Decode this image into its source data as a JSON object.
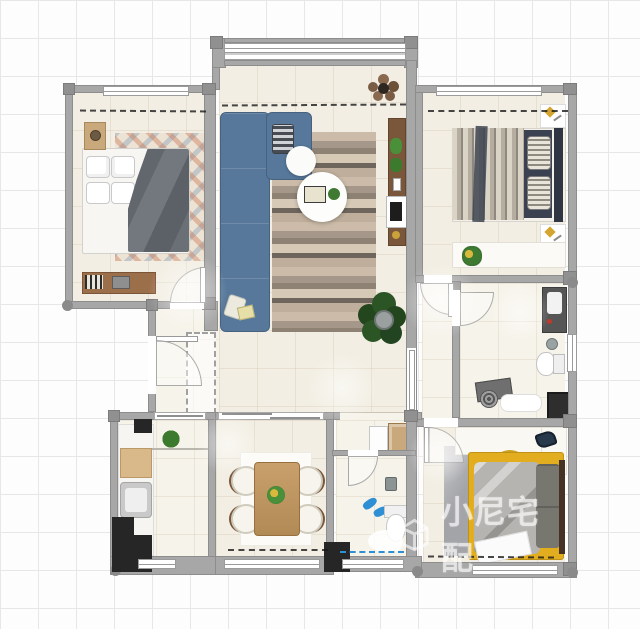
{
  "watermark": {
    "text": "小尼宅配",
    "icon": "house-cube-icon"
  },
  "colors": {
    "page_bg": "#fdfdfd",
    "grid_line": "#e7e7e7",
    "wall": "#a7a7a7",
    "wall_dark": "#8d8d8d",
    "floor": "#f2eee3",
    "floor_light": "#f6f3ea",
    "black_fixture": "#262626",
    "sofa": "#57789a",
    "sofa_dark": "#46627f",
    "duvet": "#6e7278",
    "navy": "#3a4150",
    "wood_light": "#c9a87c",
    "wood_mid": "#9c6f4b",
    "wood_dark": "#7a563b",
    "yellow": "#eec437",
    "plant": "#3f7a33",
    "plant_dark": "#24461f",
    "rug_cream": "#ece3d4",
    "gray_rug": "#a3a4a8",
    "accent_orange": "#c8714f",
    "accent_blue": "#8fa3b5",
    "slipper_blue": "#2e8fd4",
    "watermark": "rgba(255,255,255,0.6)"
  },
  "plan": {
    "rooms": [
      {
        "id": "bedroom-1",
        "furniture": [
          "double-bed",
          "pillows",
          "gray-duvet",
          "patterned-rug",
          "nightstand",
          "table-lamp",
          "desk",
          "books",
          "laptop"
        ]
      },
      {
        "id": "living-room",
        "furniture": [
          "sectional-sofa",
          "striped-pillow",
          "throw-blanket",
          "plank-rug",
          "round-coffee-table",
          "side-table",
          "serving-tray",
          "potted-plant",
          "tv-console",
          "television",
          "dried-plant"
        ]
      },
      {
        "id": "master-bedroom",
        "furniture": [
          "double-bed",
          "striped-duvet",
          "headboard",
          "nightstand",
          "gold-decor",
          "low-dresser",
          "potted-plant"
        ]
      },
      {
        "id": "bathroom-1",
        "furniture": [
          "vanity-sink",
          "toilet",
          "shower-set",
          "floor-drain",
          "bath-mat",
          "washing-machine"
        ]
      },
      {
        "id": "bedroom-2",
        "furniture": [
          "single-bed",
          "yellow-frame",
          "gray-blanket",
          "dark-pillows",
          "gray-rug",
          "desk",
          "desk-lamp",
          "yellow-chair",
          "potted-plant"
        ]
      },
      {
        "id": "bathroom-2",
        "furniture": [
          "vanity",
          "mirror",
          "toilet",
          "shower-head",
          "slippers"
        ]
      },
      {
        "id": "dining-room",
        "furniture": [
          "dining-table",
          "four-chairs",
          "centerpiece-plant",
          "white-rug"
        ]
      },
      {
        "id": "kitchen",
        "furniture": [
          "counter",
          "sink",
          "cutting-board",
          "shelf-plant"
        ]
      },
      {
        "id": "entry-hall",
        "furniture": [
          "entry-door",
          "shoe-cabinet-outline",
          "indoor-plant"
        ]
      }
    ],
    "annotations": [
      "dimension-sketch-lines",
      "blue-dimension-line",
      "door-swing-arcs",
      "window-symbols",
      "structural-columns"
    ]
  }
}
